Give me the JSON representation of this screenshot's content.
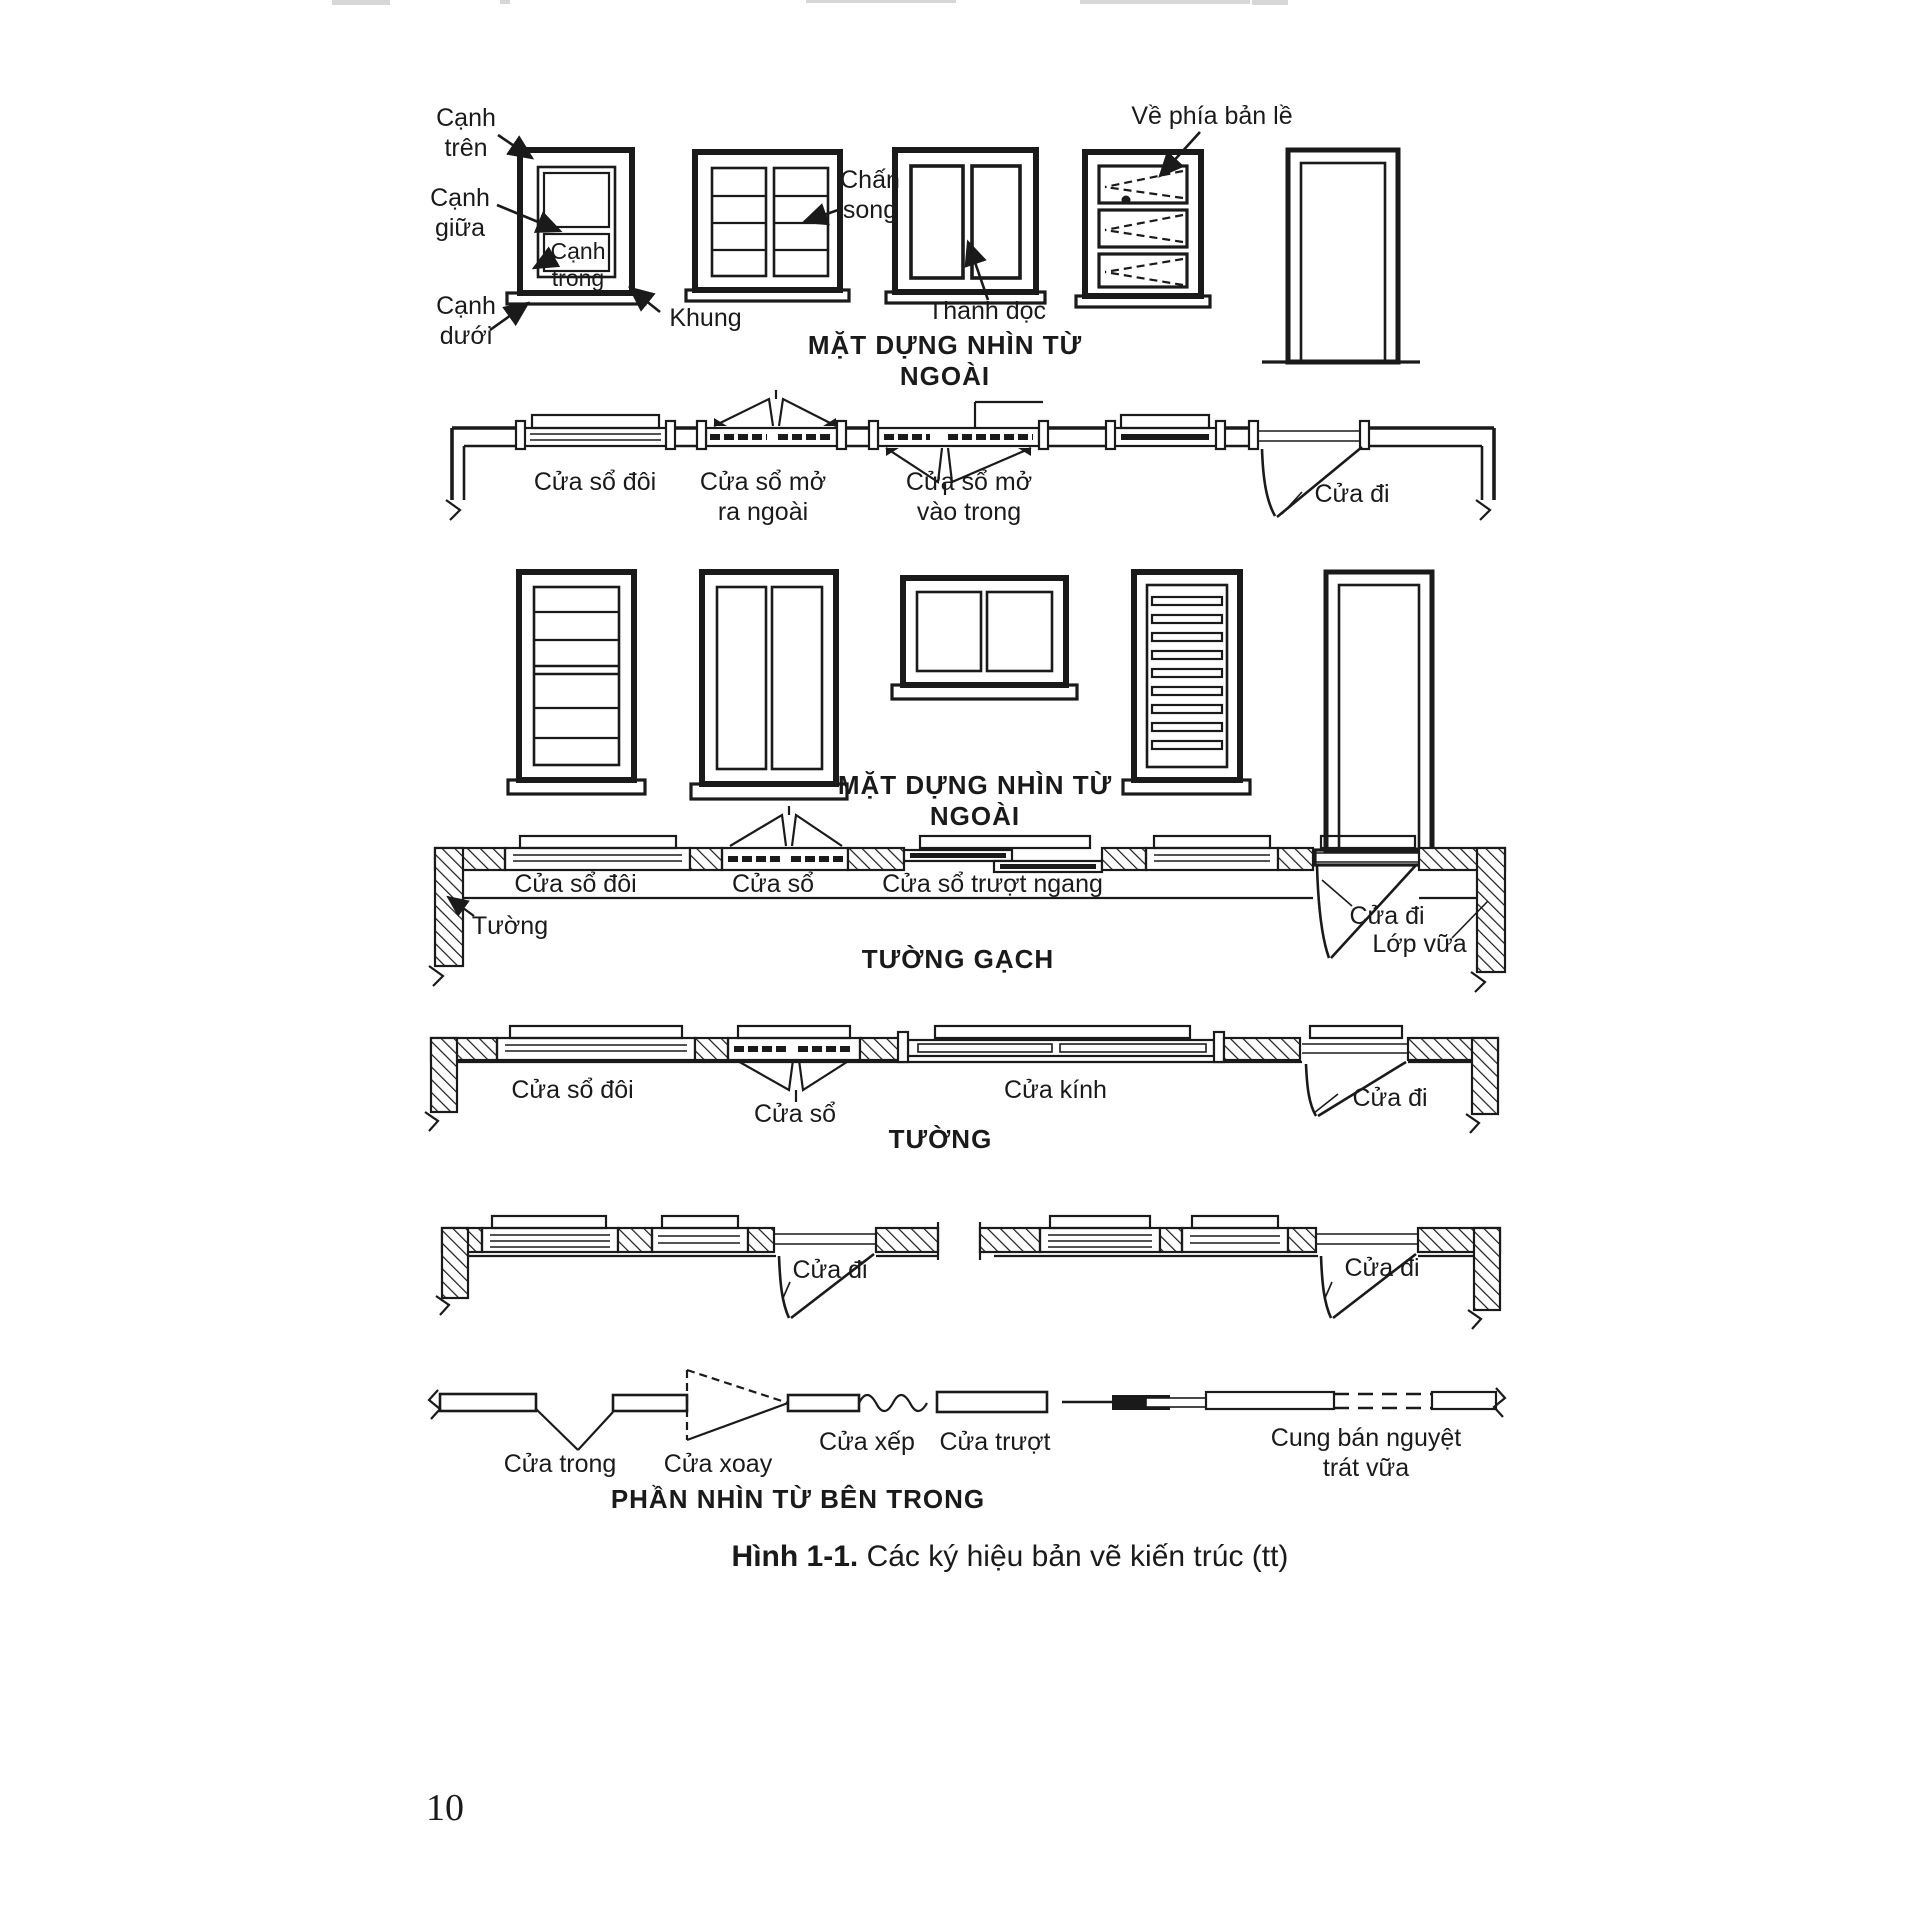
{
  "colors": {
    "ink": "#1a1a1a",
    "paper": "#ffffff"
  },
  "page": {
    "number": "10"
  },
  "caption": {
    "figure_label": "Hình 1-1.",
    "text": "Các ký hiệu bản vẽ kiến trúc (tt)"
  },
  "titles": {
    "elevation1": "MẶT DỰNG NHÌN TỪ NGOÀI",
    "elevation2": "MẶT DỰNG NHÌN TỪ NGOÀI",
    "brick_wall": "TƯỜNG GẠCH",
    "wall": "TƯỜNG",
    "interior": "PHẦN NHÌN TỪ BÊN TRONG"
  },
  "elevation_labels": {
    "top_edge": "Cạnh\ntrên",
    "middle_edge": "Cạnh\ngiữa",
    "inner_edge": "Cạnh\ntrong",
    "bottom_edge": "Cạnh\ndưới",
    "frame": "Khung",
    "bars": "Chấn\nsong",
    "vertical_bar": "Thanh dọc",
    "hinge_side": "Về phía bản lề"
  },
  "plan1": {
    "double_window": "Cửa sổ đôi",
    "window_opening_out": "Cửa sổ mở\nra ngoài",
    "window_opening_in": "Cửa sổ mở\nvào trong",
    "door": "Cửa đi"
  },
  "plan2": {
    "double_window": "Cửa sổ đôi",
    "window": "Cửa sổ",
    "sliding_window": "Cửa sổ trượt ngang",
    "wall": "Tường",
    "door": "Cửa đi",
    "plaster": "Lớp vữa"
  },
  "plan3": {
    "double_window": "Cửa sổ đôi",
    "window": "Cửa sổ",
    "glass_door": "Cửa kính",
    "door": "Cửa đi"
  },
  "plan4": {
    "door_left": "Cửa đi",
    "door_right": "Cửa đi"
  },
  "interior_symbols": {
    "inner_door": "Cửa trong",
    "revolving_door": "Cửa xoay",
    "folding_door": "Cửa xếp",
    "sliding_door": "Cửa trượt",
    "plaster_arch": "Cung bán nguyệt\ntrát vữa"
  }
}
